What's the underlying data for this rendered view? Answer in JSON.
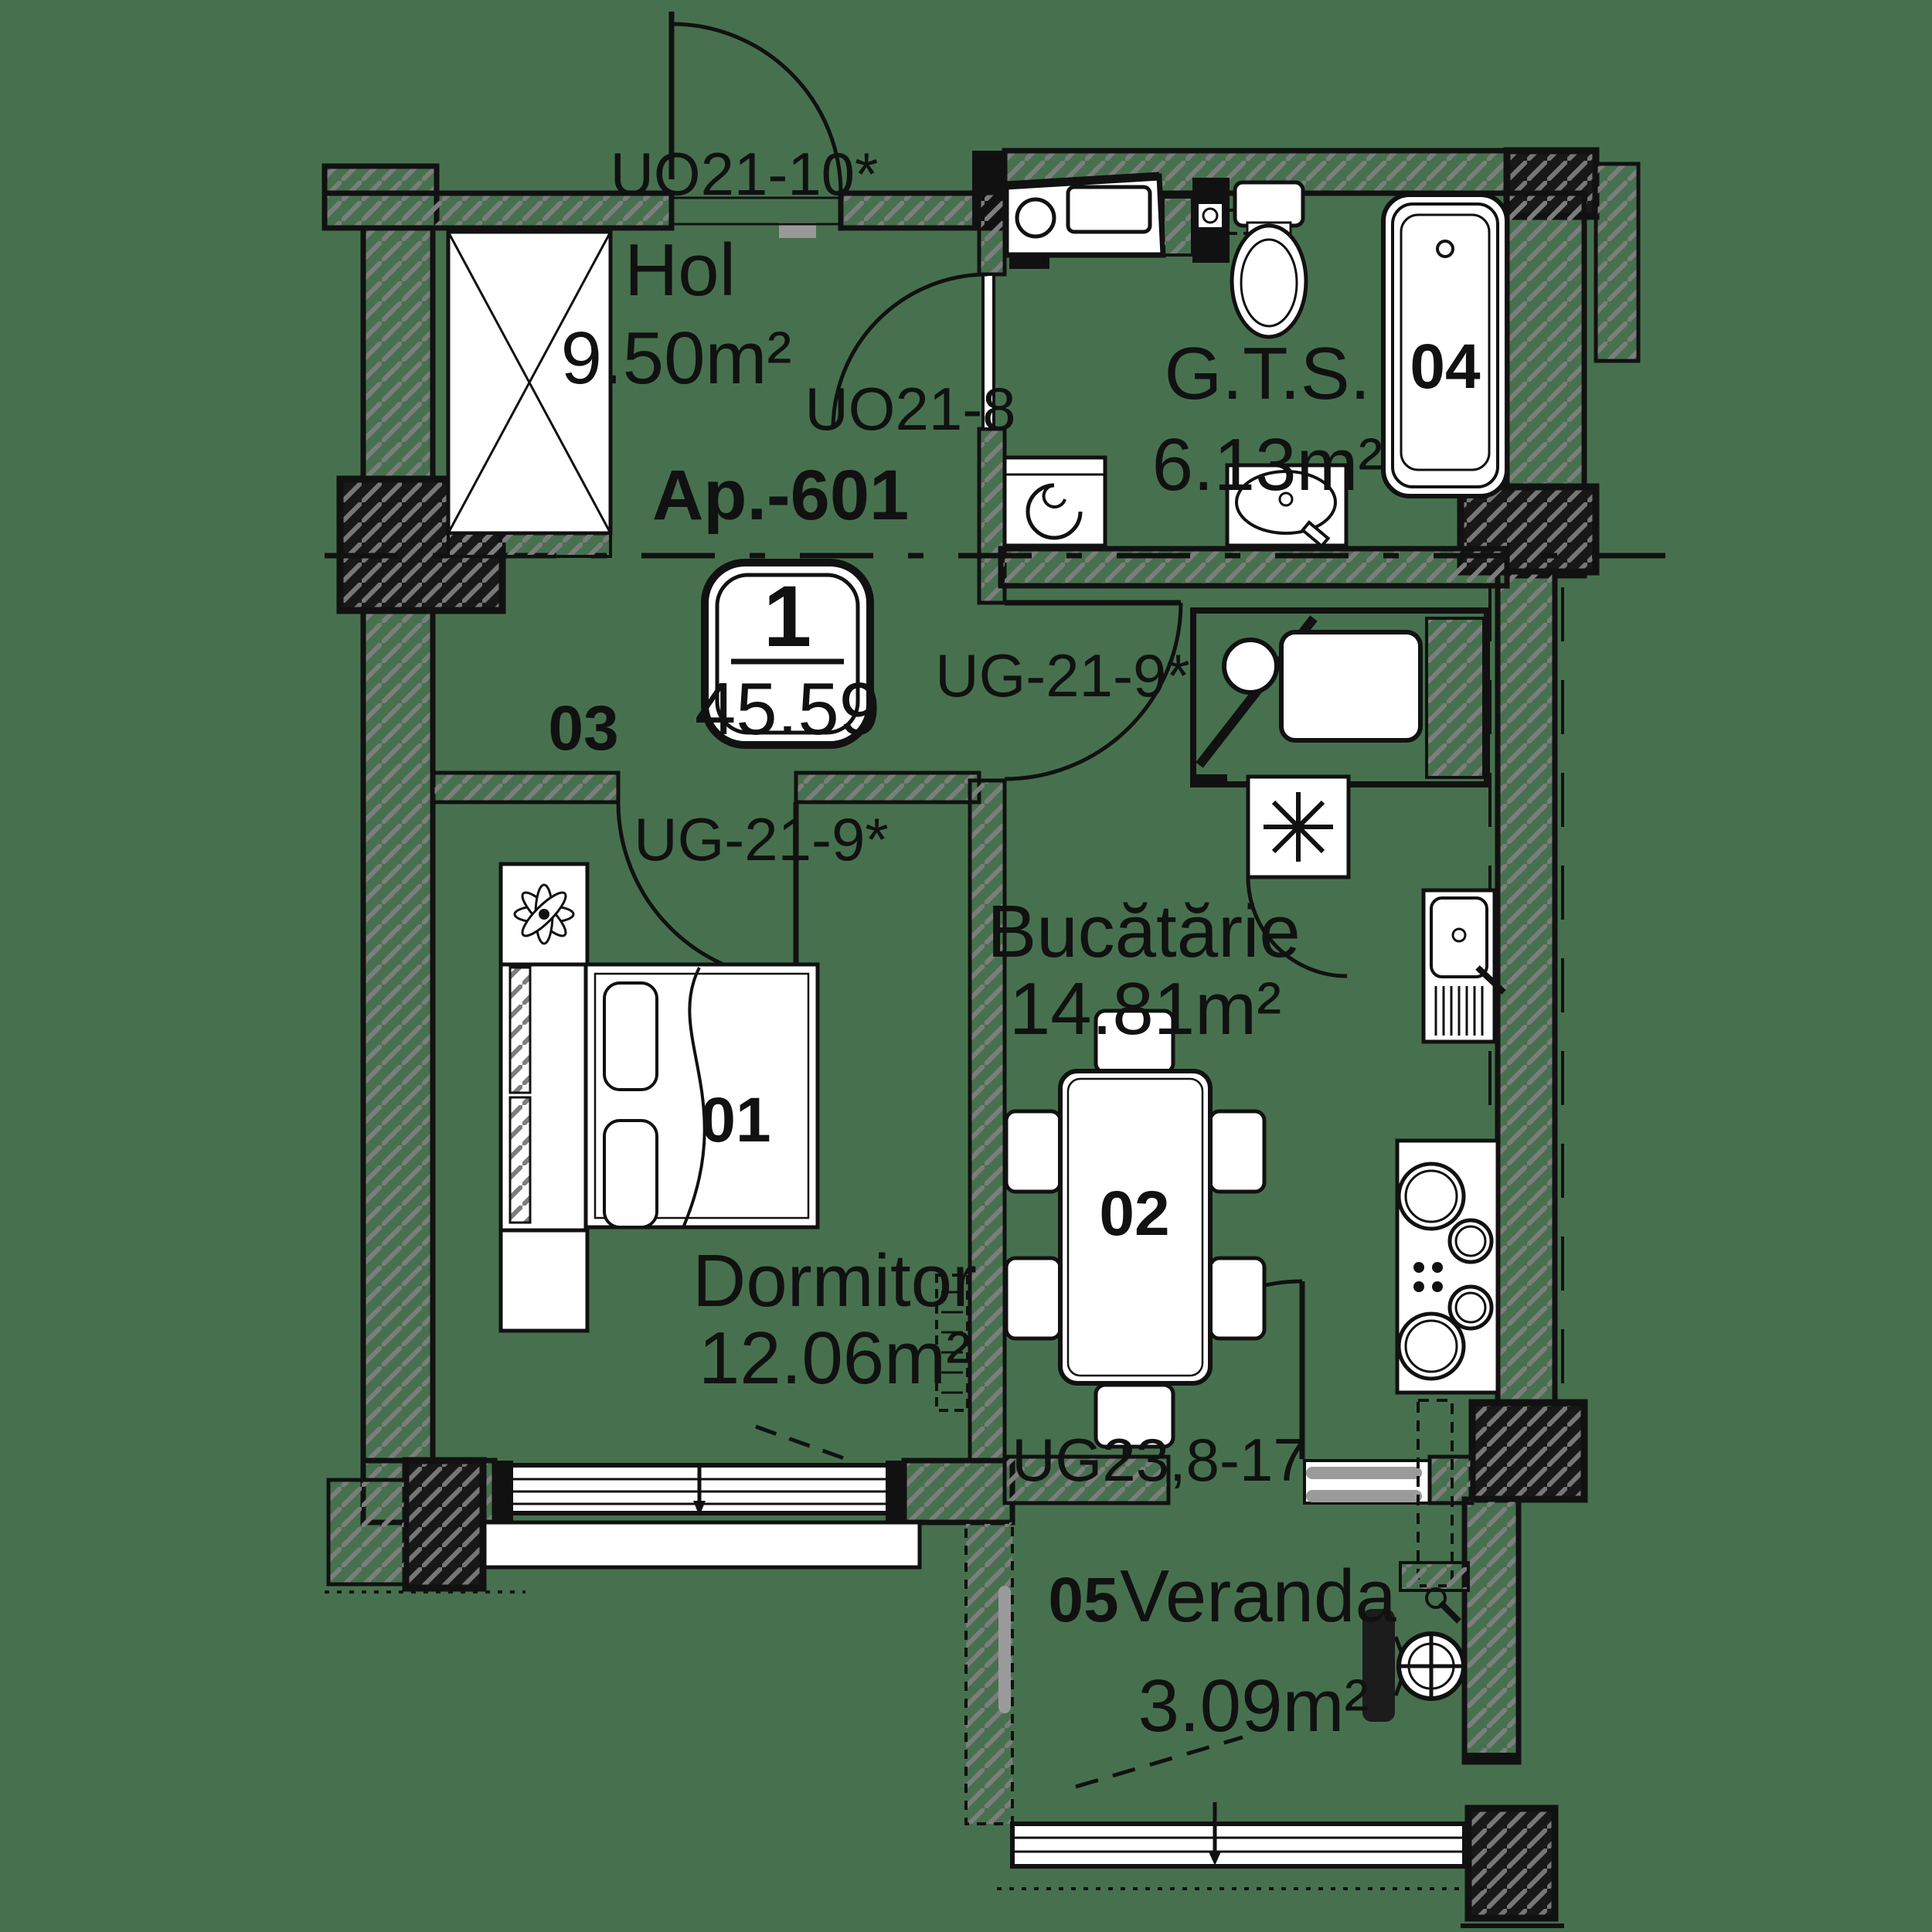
{
  "apartment": {
    "label": "Ap.-601",
    "badge_rooms": "1",
    "badge_area": "45.59"
  },
  "rooms": {
    "hol": {
      "number": "03",
      "name": "Hol",
      "area": "9.50m²"
    },
    "gts": {
      "number": "04",
      "name": "G.T.S.",
      "area": "6.13m²"
    },
    "bucatarie": {
      "number": "02",
      "name": "Bucătărie",
      "area": "14.81m²"
    },
    "dormitor": {
      "number": "01",
      "name": "Dormitor",
      "area": "12.06m²"
    },
    "veranda": {
      "number": "05",
      "name": "Veranda",
      "area": "3.09m²"
    }
  },
  "door_labels": {
    "entry": "UO21-10*",
    "bathroom": "UO21-8",
    "kitchen": "UG-21-9*",
    "bedroom": "UG-21-9*",
    "veranda": "UG23,8-17"
  },
  "colors": {
    "background": "#47714E",
    "line": "#111111",
    "hatch": "#7d7d7d",
    "fixture_fill": "#ffffff",
    "threshold_gray": "#9a9a9a"
  }
}
